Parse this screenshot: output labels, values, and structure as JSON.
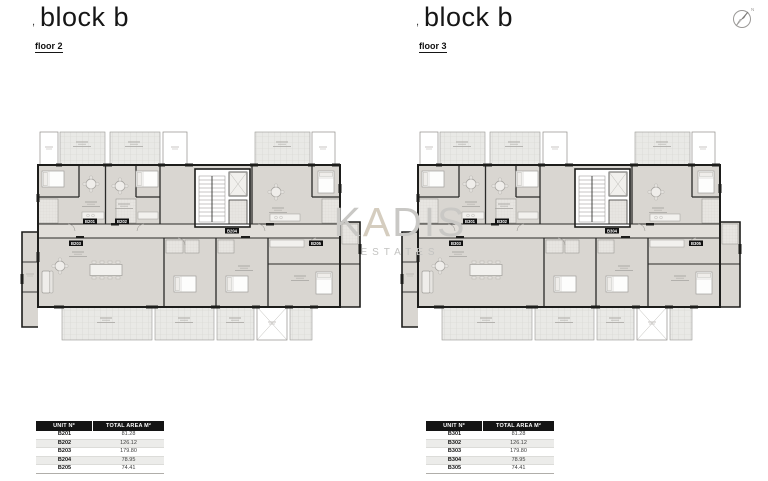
{
  "panels": [
    {
      "title": "block b",
      "title_mark": ",",
      "floor_label": "floor 2",
      "plan_tags": [
        "B201",
        "B202",
        "B203",
        "B204",
        "B205"
      ],
      "table": {
        "headers": [
          "UNIT Nº",
          "TOTAL AREA M²"
        ],
        "rows": [
          [
            "B201",
            "81.28"
          ],
          [
            "B202",
            "126.12"
          ],
          [
            "B203",
            "179.80"
          ],
          [
            "B204",
            "78.95"
          ],
          [
            "B205",
            "74.41"
          ]
        ]
      }
    },
    {
      "title": "block b",
      "title_mark": ",",
      "floor_label": "floor 3",
      "plan_tags": [
        "B301",
        "B302",
        "B303",
        "B304",
        "B305"
      ],
      "table": {
        "headers": [
          "UNIT Nº",
          "TOTAL AREA M²"
        ],
        "rows": [
          [
            "B301",
            "81.28"
          ],
          [
            "B302",
            "126.12"
          ],
          [
            "B303",
            "179.80"
          ],
          [
            "B304",
            "78.95"
          ],
          [
            "B305",
            "74.41"
          ]
        ]
      }
    }
  ],
  "watermark": {
    "k": "K",
    "a": "A",
    "dis": "DIS",
    "line2": "ESTATES"
  },
  "compass": {
    "label": "N"
  },
  "colors": {
    "wall": "#1d1d1b",
    "room_fill": "#d9d6d1",
    "corridor_fill": "#e1ded9",
    "veranda_fill": "#e9e9e6",
    "watermark_gray": "#c9c8c5",
    "watermark_accent": "#d5cdbf",
    "table_header_bg": "#141414"
  }
}
